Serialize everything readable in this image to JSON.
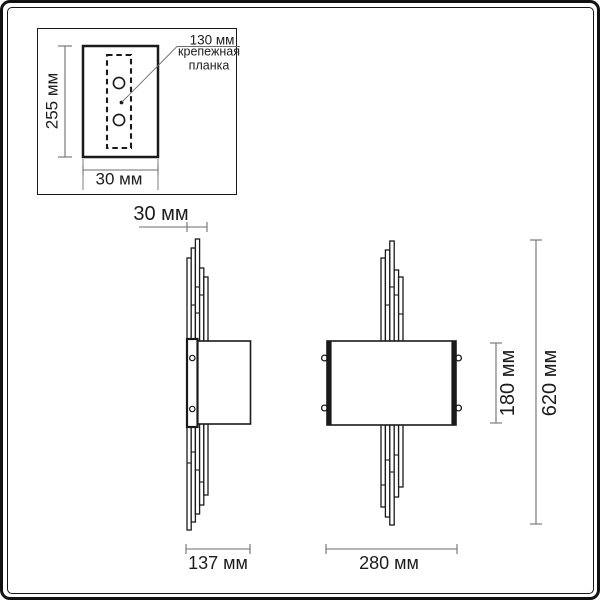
{
  "colors": {
    "drawing_line": "#1a1a1a",
    "dimension_line": "#6e6e6e",
    "text": "#1c1c1c",
    "background": "#ffffff"
  },
  "detail_box": {
    "plate_height": "255 мм",
    "plate_width": "30 мм",
    "callout_value": "130 мм",
    "callout_name": "крепежная\nпланка"
  },
  "side_view": {
    "depth": "30 мм",
    "width": "137 мм"
  },
  "front_view": {
    "width": "280 мм",
    "shade_height": "180 мм",
    "total_height": "620 мм"
  }
}
